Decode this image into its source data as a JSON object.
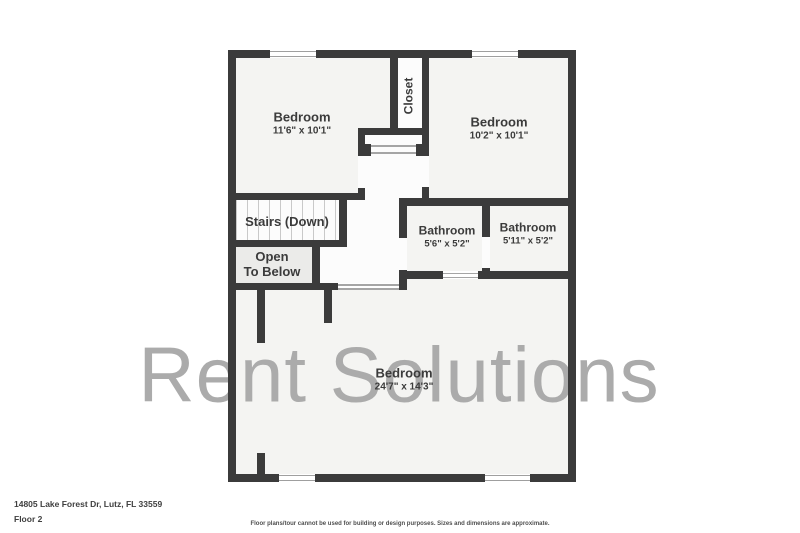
{
  "watermark": "Rent Solutions",
  "rooms": {
    "bedroom_top_left": {
      "name": "Bedroom",
      "dims": "11'6\" x 10'1\""
    },
    "bedroom_top_right": {
      "name": "Bedroom",
      "dims": "10'2\" x 10'1\""
    },
    "closet": {
      "name": "Closet"
    },
    "stairs": {
      "name": "Stairs (Down)"
    },
    "open_to_below": {
      "line1": "Open",
      "line2": "To Below"
    },
    "bathroom_left": {
      "name": "Bathroom",
      "dims": "5'6\" x 5'2\""
    },
    "bathroom_right": {
      "name": "Bathroom",
      "dims": "5'11\" x 5'2\""
    },
    "bedroom_bottom": {
      "name": "Bedroom",
      "dims": "24'7\" x 14'3\""
    }
  },
  "footer": {
    "address": "14805 Lake Forest Dr, Lutz, FL 33559",
    "floor": "Floor 2",
    "disclaimer": "Floor plans/tour cannot be used for building or design purposes. Sizes and dimensions are approximate."
  },
  "colors": {
    "wall": "#3b3b3b",
    "room_fill": "#f4f4f2",
    "hall_fill": "#fcfcfc",
    "open_to_below_fill": "#ebebe9",
    "watermark": "#ababab",
    "text": "#3b3b3b"
  }
}
